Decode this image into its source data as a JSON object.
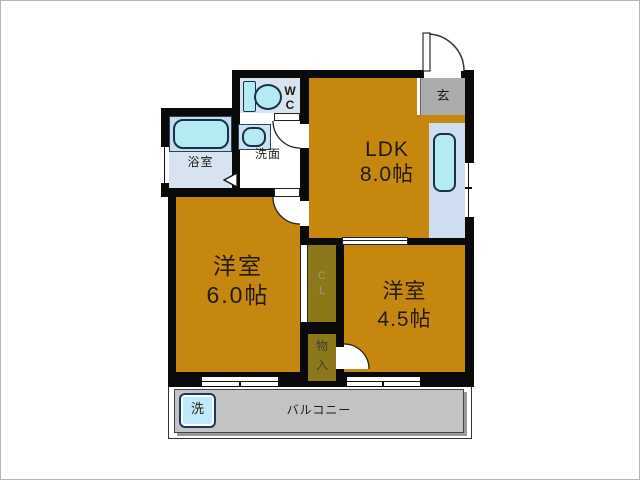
{
  "rooms": {
    "ldk": {
      "name": "LDK",
      "size": "8.0帖"
    },
    "bedroom6": {
      "name": "洋室",
      "size": "6.0帖"
    },
    "bedroom45": {
      "name": "洋室",
      "size": "4.5帖"
    },
    "bathroom": {
      "label": "浴室"
    },
    "washroom": {
      "label": "洗面"
    },
    "wc": {
      "letter1": "W",
      "letter2": "C"
    },
    "entrance": {
      "label": "玄"
    },
    "closet": {
      "letter1": "C",
      "letter2": "L"
    },
    "storage": {
      "char1": "物",
      "char2": "入"
    },
    "balcony": {
      "label": "バルコニー"
    },
    "washer": {
      "label": "洗"
    }
  },
  "colors": {
    "room_fill": "#C6870E",
    "closet_fill": "#8C781A",
    "wall": "#0A0A0A",
    "water_fixture": "#B6EAF2",
    "wet_room_fill": "#D7E4EF",
    "kitchen_counter_fill": "#CEDEF0",
    "entrance_fill": "#ACACAC",
    "balcony_fill": "#C3C3C3"
  }
}
